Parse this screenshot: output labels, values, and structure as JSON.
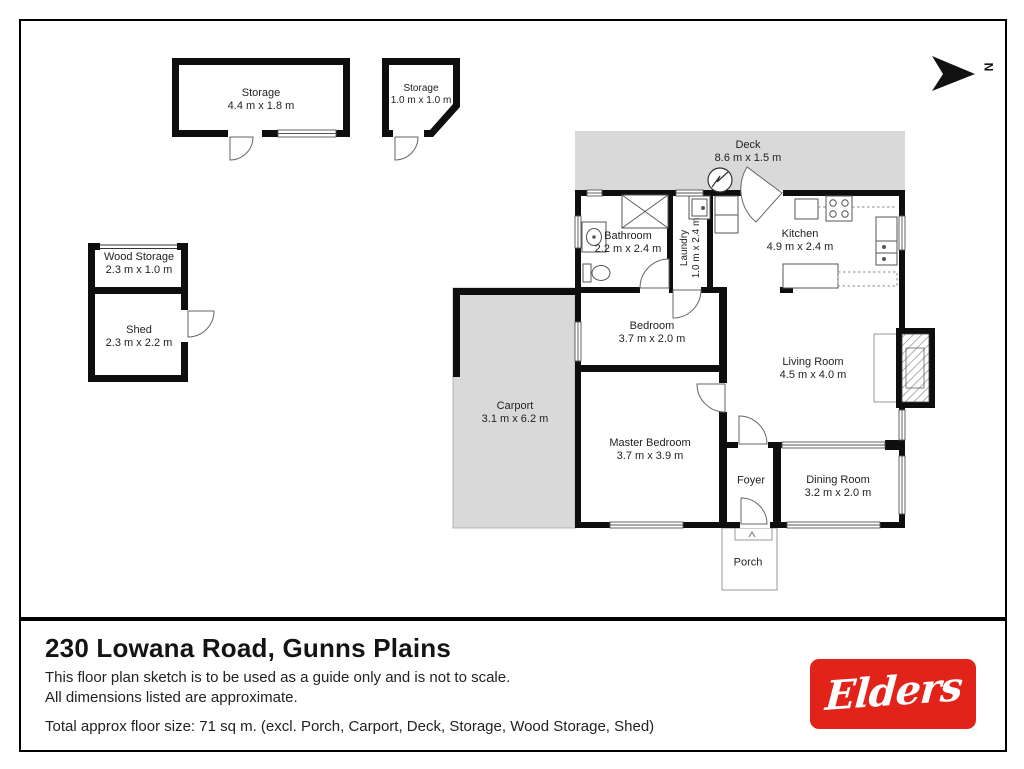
{
  "north_label": "N",
  "outbuildings": {
    "storage_large": {
      "name": "Storage",
      "dims": "4.4 m x 1.8 m"
    },
    "storage_small": {
      "name": "Storage",
      "dims": "1.0 m x 1.0 m"
    },
    "wood_storage": {
      "name": "Wood Storage",
      "dims": "2.3 m x 1.0 m"
    },
    "shed": {
      "name": "Shed",
      "dims": "2.3 m x 2.2 m"
    }
  },
  "rooms": {
    "deck": {
      "name": "Deck",
      "dims": "8.6 m x 1.5 m"
    },
    "bathroom": {
      "name": "Bathroom",
      "dims": "2.2 m x 2.4 m"
    },
    "laundry": {
      "name": "Laundry",
      "dims": "1.0 m x 2.4 m"
    },
    "kitchen": {
      "name": "Kitchen",
      "dims": "4.9 m x 2.4 m"
    },
    "bedroom": {
      "name": "Bedroom",
      "dims": "3.7 m x 2.0 m"
    },
    "living_room": {
      "name": "Living Room",
      "dims": "4.5 m x 4.0 m"
    },
    "carport": {
      "name": "Carport",
      "dims": "3.1 m x 6.2 m"
    },
    "master_bedroom": {
      "name": "Master Bedroom",
      "dims": "3.7 m x 3.9 m"
    },
    "foyer": {
      "name": "Foyer"
    },
    "dining_room": {
      "name": "Dining Room",
      "dims": "3.2 m x 2.0 m"
    },
    "porch": {
      "name": "Porch"
    }
  },
  "footer": {
    "title": "230 Lowana Road, Gunns Plains",
    "disclaimer_line1": "This floor plan sketch is to be used as a guide only and is not to scale.",
    "disclaimer_line2": "All dimensions listed are approximate.",
    "total_size": "Total approx floor size:  71 sq m. (excl. Porch, Carport, Deck, Storage, Wood Storage, Shed)",
    "brand": "Elders"
  },
  "colors": {
    "brand_red": "#E2231A",
    "wall_black": "#0e0e0e",
    "paved_gray": "#d9d9d9"
  }
}
